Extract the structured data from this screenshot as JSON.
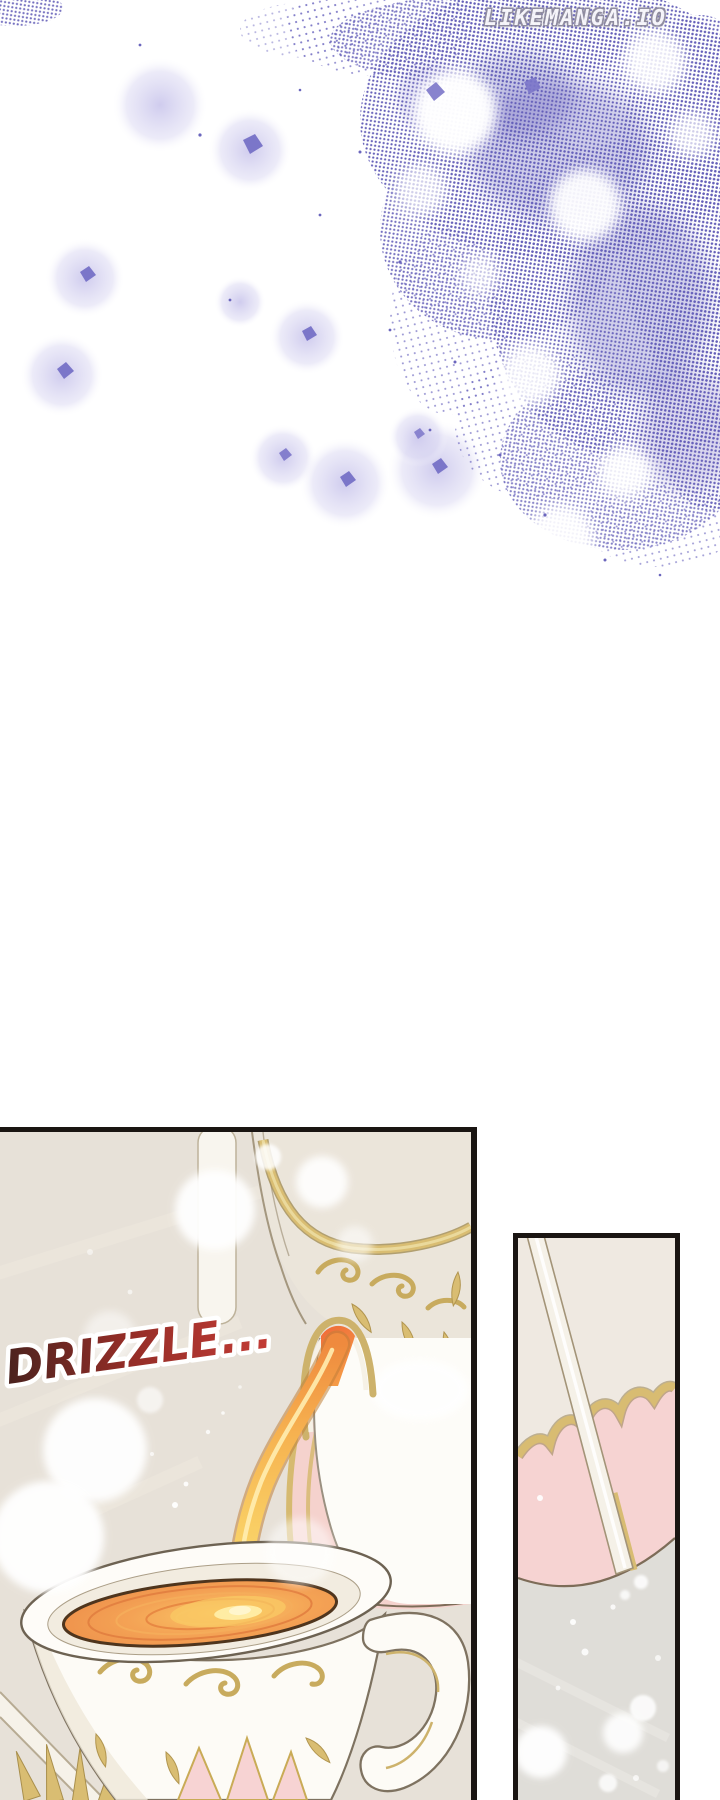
{
  "page": {
    "width": 720,
    "height": 1800,
    "background": "#ffffff"
  },
  "watermark": {
    "text": "LIKEMANGA.IO",
    "fill": "#f7f6fa",
    "outline": "#8d8a9c"
  },
  "top_art": {
    "description": "purple stippled sparkle clouds with drifting violet shards and soft glows",
    "stipple_color": "#645fb8",
    "shard_color": "#7b76c9",
    "glow_color": "#cac6ec"
  },
  "panels": {
    "main": {
      "name": "tea pouring close-up panel",
      "sfx": "DRIZZLE...",
      "sfx_color_start": "#4a221e",
      "sfx_color_mid": "#932d27",
      "sfx_color_end": "#c43c36",
      "sfx_outline": "#ffffff",
      "border_color": "#1a1512",
      "background": "#e7e1d8",
      "tea_color": "#ef9150",
      "tea_outline": "#4f351d",
      "stream_top": "#ef6a38",
      "stream_bottom": "#fbd973",
      "gold_trim": "#d9bd72",
      "porcelain": "#fdfbf6",
      "pink_accent": "#f5d2cd"
    },
    "side": {
      "name": "pink saucer and spoon close-up panel",
      "border_color": "#1a1512",
      "background": "#efe9e1",
      "pink_saucer": "#f6d3d2",
      "gold_trim": "#d8bc72",
      "table_color": "#dfddd8",
      "spoon_color": "#f5f1e8"
    }
  }
}
